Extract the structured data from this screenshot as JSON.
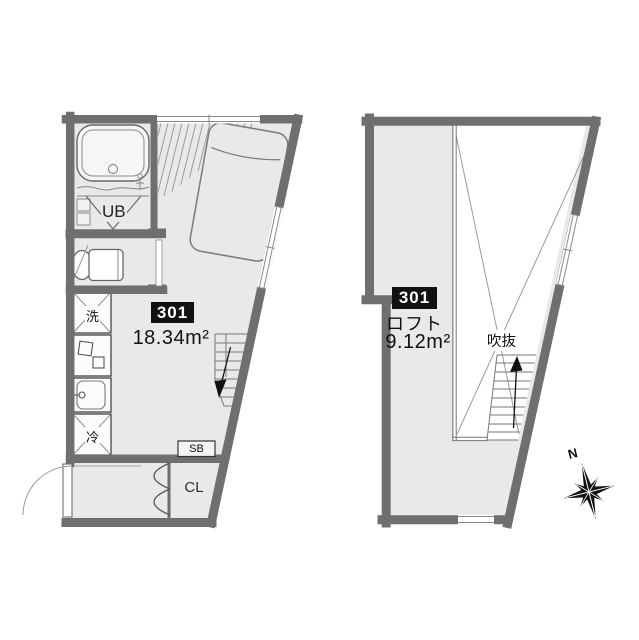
{
  "left_plan": {
    "badge": "301",
    "area": "18.34m²",
    "ub_label": "UB",
    "wash_label": "洗",
    "fridge_label": "冷",
    "sb_label": "SB",
    "cl_label": "CL"
  },
  "right_plan": {
    "badge": "301",
    "loft_label": "ロフト",
    "area": "9.12m²",
    "void_label": "吹抜"
  },
  "compass": {
    "north_label": "N"
  },
  "colors": {
    "wall": "#6f6f6f",
    "floor": "#e9e9e9",
    "badge_bg": "#111111",
    "badge_text": "#ffffff"
  }
}
